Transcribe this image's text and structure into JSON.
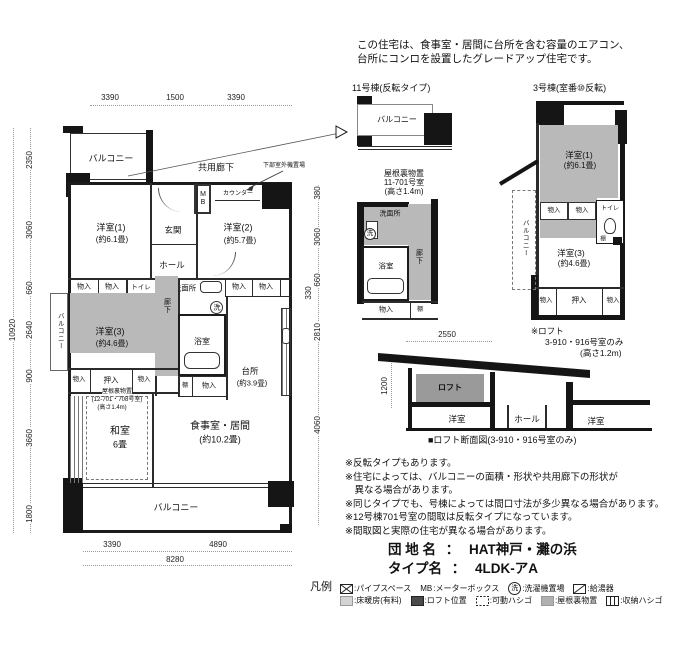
{
  "h": {
    "l1": "この住宅は、食事室・居間に台所を含む容量のエアコン、",
    "l2": "台所にコンロを設置したグレードアップ住宅です。"
  },
  "L": {
    "balcony": "バルコニー",
    "common_corridor": "共用廊下",
    "outdoor_unit": "下部室外機置場",
    "mb": "MB",
    "counter": "カウンター",
    "entrance": "玄関",
    "hall": "ホール",
    "western1": "洋室(1)",
    "western1_size": "(約6.1畳)",
    "western2": "洋室(2)",
    "western2_size": "(約5.7畳)",
    "western3": "洋室(3)",
    "western3_size": "(約4.6畳)",
    "western": "洋室",
    "closet": "物入",
    "oshiire": "押入",
    "toilet": "トイレ",
    "washroom": "洗面所",
    "bathroom": "浴室",
    "corridor": "廊下",
    "shelf": "棚",
    "washer": "洗",
    "kitchen": "台所",
    "kitchen_size": "(約3.9畳)",
    "japanese_room": "和室",
    "japanese_room_size": "6畳",
    "dining": "食事室・居間",
    "dining_size": "(約10.2畳)",
    "loft": "ロフト"
  },
  "mp": {
    "dt": [
      "3390",
      "1500",
      "3390"
    ],
    "dl": [
      "2350",
      "3060",
      "660",
      "2640",
      "900",
      "3660",
      "1800"
    ],
    "dlt": "10920",
    "dr": [
      "380",
      "3060",
      "660",
      "330",
      "2810",
      "4060"
    ],
    "db": [
      "3390",
      "4890"
    ],
    "dbt": "8280",
    "attic": {
      "l1": "屋根裏物置",
      "l2": "(12-701・708号室)",
      "l3": "(高さ1.4m)"
    }
  },
  "b11": {
    "title": "11号棟(反転タイプ)",
    "attic": {
      "l1": "屋根裏物置",
      "l2": "11-701号室",
      "l3": "(高さ1.4m)"
    }
  },
  "b3": {
    "title": "3号棟(室番⑩反転)",
    "note": {
      "l1": "※ロフト",
      "l2": "3-910・916号室のみ",
      "l3": "(高さ1.2m)"
    }
  },
  "ls": {
    "w": "2550",
    "h": "1200",
    "caption": "■ロフト断面図(3-910・916号室のみ)"
  },
  "notes": [
    "※反転タイプもあります。",
    "※住宅によっては、バルコニーの面積・形状や共用廊下の形状が",
    "　異なる場合があります。",
    "※同じタイプでも、号棟によっては間口寸法が多少異なる場合があります。",
    "※12号棟701号室の間取は反転タイプになっています。",
    "※間取図と実際の住宅が異なる場合があります。"
  ],
  "tb": {
    "estate_label": "団 地 名",
    "sep": "：",
    "estate_value": "HAT神戸・灘の浜",
    "type_label": "タイプ名",
    "type_value": "4LDK-アA"
  },
  "lg": {
    "title": "凡例",
    "pipe": ":パイプスペース",
    "mb_key": "MB",
    "mb": ":メーターボックス",
    "washer_key": "洗",
    "washer": ":洗濯機置場",
    "heater": ":給湯器",
    "floorheat": ":床暖房(有料)",
    "loftpos": ":ロフト位置",
    "ladder1": ":可動ハシゴ",
    "attic": ":屋根裏物置",
    "ladder2": ":収納ハシゴ"
  }
}
